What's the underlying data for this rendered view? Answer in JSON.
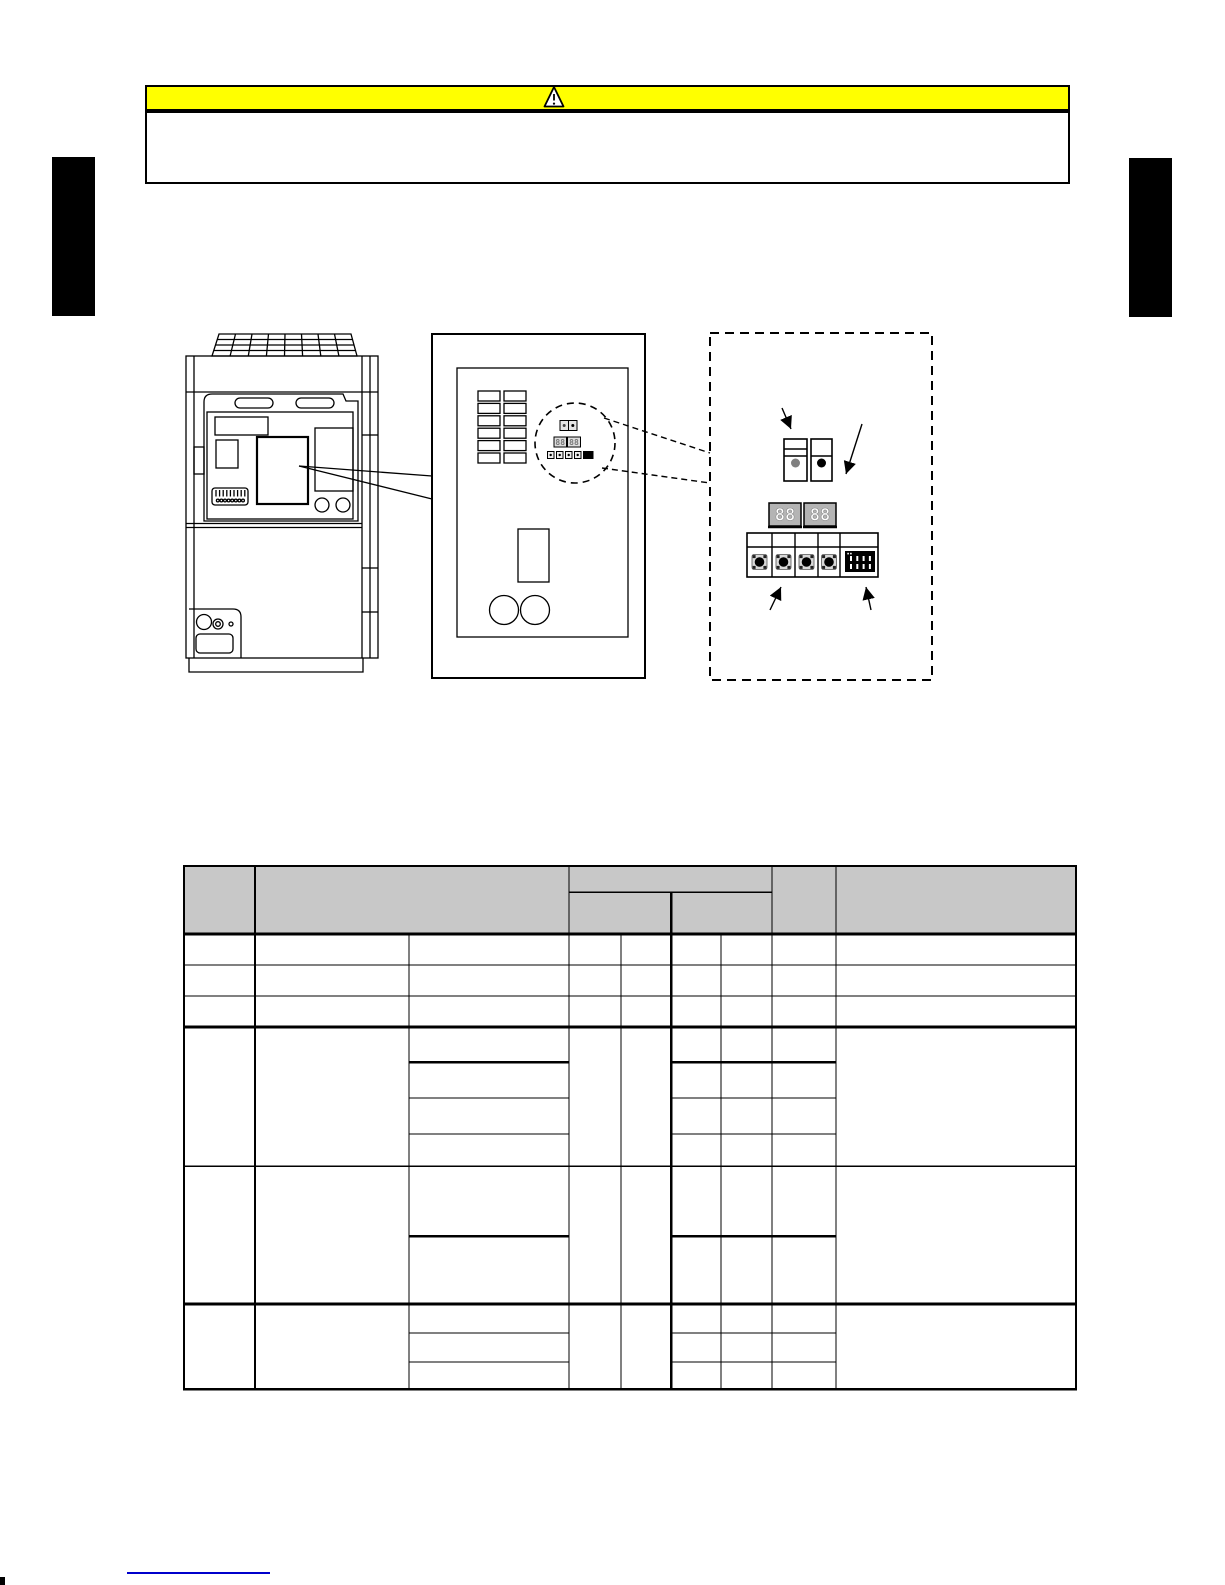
{
  "page": {
    "width": 1225,
    "height": 1585,
    "background": "#ffffff"
  },
  "caution_banner": {
    "bar_color": "#ffff00",
    "border_color": "#000000",
    "icon": "warning-triangle-icon",
    "text": ""
  },
  "side_tabs": {
    "color": "#000000",
    "count": 2
  },
  "figure": {
    "unit": {
      "type": "outdoor-unit-line-drawing",
      "features": [
        "fan-grille",
        "front-panel",
        "control-plate",
        "terminal-strip",
        "service-valves"
      ]
    },
    "board": {
      "type": "control-pcb-drawing",
      "connector_rows": 6,
      "connector_columns": 2,
      "display_values": [
        "88",
        "88"
      ],
      "callout": "dashed-circle"
    },
    "detail": {
      "type": "switch-and-display-detail",
      "led_left_color": "#808080",
      "led_right_color": "#000000",
      "display_values": [
        "88",
        "88"
      ],
      "button_count": 4,
      "dip_switch_color": "#000000",
      "arrow_count": 4
    }
  },
  "table": {
    "header_fill": "#c8c8c8",
    "line_color": "#000000",
    "column_edges": [
      183,
      255,
      409,
      569,
      621,
      671,
      721,
      772,
      836,
      1077
    ],
    "simple_rows": 3,
    "grouped_rows": 3,
    "all_cells_empty": true
  },
  "footer_link": {
    "color": "#0000cc"
  }
}
